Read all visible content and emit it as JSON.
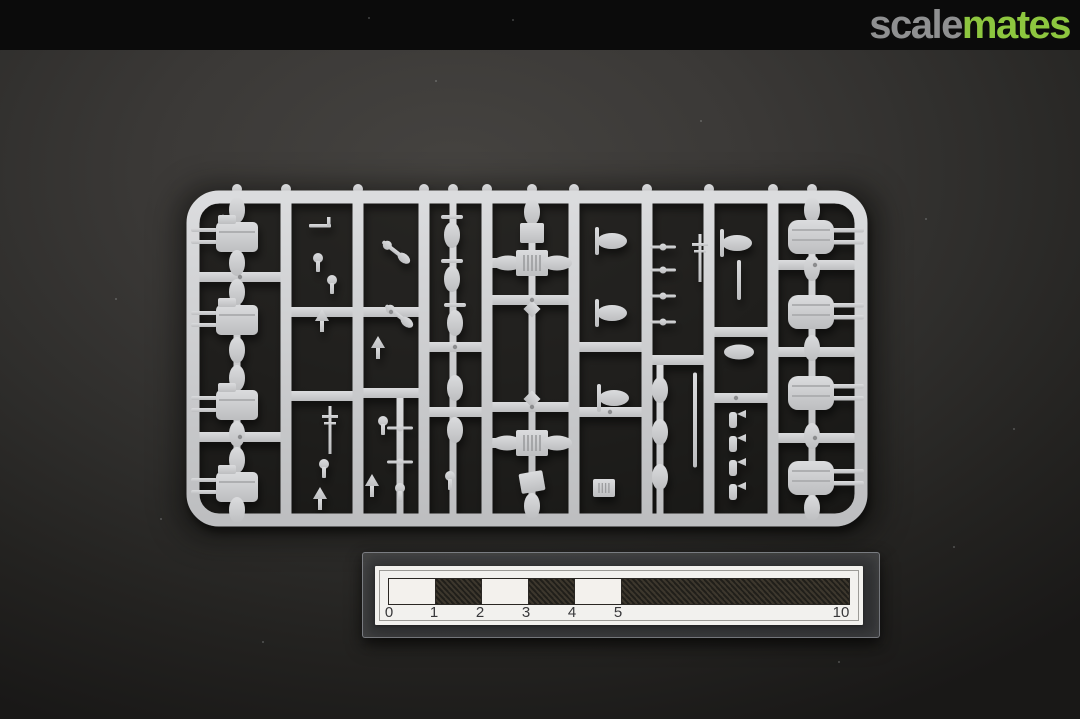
{
  "header": {
    "logo_scale": "scale",
    "logo_mates": "mates",
    "scale_color": "#8f9091",
    "mates_color": "#8dc63f",
    "bar_color": "#0b0b0b"
  },
  "scene": {
    "background_center": "#454340",
    "background_edge": "#191817",
    "subject": "injection-molded model kit sprue, light grey plastic, ship fittings parts",
    "specks": [
      [
        368,
        17
      ],
      [
        512,
        19
      ],
      [
        222,
        214
      ],
      [
        925,
        218
      ],
      [
        700,
        120
      ],
      [
        1013,
        428
      ],
      [
        115,
        298
      ],
      [
        953,
        546
      ],
      [
        262,
        641
      ],
      [
        838,
        661
      ],
      [
        160,
        518
      ],
      [
        435,
        80
      ]
    ]
  },
  "sprue": {
    "plastic_light": "#dbdcde",
    "plastic_dark": "#bdbec0",
    "ejector_dot_color": "#8b8c8e",
    "frame": {
      "x": 193,
      "y": 197,
      "w": 668,
      "h": 323,
      "rx": 26,
      "rail": 13
    },
    "runners": [
      286,
      358,
      424,
      487,
      574,
      647,
      709,
      773
    ],
    "chains": [
      [
        237,
        197,
        520
      ],
      [
        453,
        197,
        520
      ],
      [
        532,
        197,
        520
      ],
      [
        812,
        197,
        520
      ],
      [
        660,
        360,
        520
      ],
      [
        400,
        393,
        518
      ]
    ],
    "crossbars": [
      [
        193,
        286,
        277
      ],
      [
        193,
        286,
        437
      ],
      [
        286,
        358,
        312
      ],
      [
        286,
        358,
        396
      ],
      [
        358,
        424,
        312
      ],
      [
        358,
        424,
        393
      ],
      [
        424,
        487,
        347
      ],
      [
        424,
        487,
        412
      ],
      [
        487,
        574,
        300
      ],
      [
        487,
        574,
        407
      ],
      [
        487,
        517,
        263
      ],
      [
        547,
        574,
        263
      ],
      [
        487,
        517,
        443
      ],
      [
        547,
        574,
        443
      ],
      [
        574,
        647,
        347
      ],
      [
        574,
        647,
        412
      ],
      [
        647,
        709,
        360
      ],
      [
        709,
        773,
        332
      ],
      [
        709,
        773,
        398
      ],
      [
        773,
        857,
        265
      ],
      [
        773,
        857,
        352
      ],
      [
        773,
        857,
        438
      ]
    ],
    "parts": [
      {
        "t": "ovalV",
        "x": 237,
        "y": 210
      },
      {
        "t": "turretL",
        "x": 237,
        "y": 237
      },
      {
        "t": "ovalV",
        "x": 237,
        "y": 263
      },
      {
        "t": "ovalV",
        "x": 237,
        "y": 292
      },
      {
        "t": "turretL",
        "x": 237,
        "y": 320
      },
      {
        "t": "ovalV",
        "x": 237,
        "y": 350
      },
      {
        "t": "ovalV",
        "x": 237,
        "y": 378
      },
      {
        "t": "turretL",
        "x": 237,
        "y": 405
      },
      {
        "t": "ovalV",
        "x": 237,
        "y": 434
      },
      {
        "t": "ovalV",
        "x": 237,
        "y": 460
      },
      {
        "t": "turretL",
        "x": 237,
        "y": 487
      },
      {
        "t": "ovalV",
        "x": 237,
        "y": 510
      },
      {
        "t": "davit",
        "x": 320,
        "y": 226
      },
      {
        "t": "mountS",
        "x": 318,
        "y": 262
      },
      {
        "t": "mountS",
        "x": 332,
        "y": 284
      },
      {
        "t": "arrow",
        "x": 322,
        "y": 320
      },
      {
        "t": "mastV",
        "x": 330,
        "y": 430
      },
      {
        "t": "mountS",
        "x": 324,
        "y": 468
      },
      {
        "t": "arrow",
        "x": 320,
        "y": 498
      },
      {
        "t": "diag",
        "x": 396,
        "y": 252,
        "rot": 38
      },
      {
        "t": "diag",
        "x": 399,
        "y": 316,
        "rot": 38
      },
      {
        "t": "arrow",
        "x": 378,
        "y": 347
      },
      {
        "t": "mountS",
        "x": 383,
        "y": 425
      },
      {
        "t": "yardH",
        "x": 400,
        "y": 428
      },
      {
        "t": "yardH",
        "x": 400,
        "y": 462
      },
      {
        "t": "arrow",
        "x": 372,
        "y": 485
      },
      {
        "t": "mountS",
        "x": 400,
        "y": 492
      },
      {
        "t": "gunmount",
        "x": 452,
        "y": 232
      },
      {
        "t": "gunmount",
        "x": 452,
        "y": 276
      },
      {
        "t": "gunmount",
        "x": 455,
        "y": 320
      },
      {
        "t": "ovalV",
        "x": 455,
        "y": 388
      },
      {
        "t": "ovalV",
        "x": 455,
        "y": 430
      },
      {
        "t": "mountS",
        "x": 450,
        "y": 480
      },
      {
        "t": "ovalV",
        "x": 532,
        "y": 212
      },
      {
        "t": "box",
        "x": 532,
        "y": 233
      },
      {
        "t": "boatH",
        "x": 508,
        "y": 263
      },
      {
        "t": "grate",
        "x": 532,
        "y": 263
      },
      {
        "t": "boatH",
        "x": 557,
        "y": 263
      },
      {
        "t": "diamond",
        "x": 532,
        "y": 309
      },
      {
        "t": "diamond",
        "x": 532,
        "y": 399
      },
      {
        "t": "boatH",
        "x": 507,
        "y": 443
      },
      {
        "t": "grate",
        "x": 532,
        "y": 443
      },
      {
        "t": "boatH",
        "x": 557,
        "y": 443
      },
      {
        "t": "box",
        "x": 532,
        "y": 482,
        "rot": -10
      },
      {
        "t": "ovalV",
        "x": 532,
        "y": 506
      },
      {
        "t": "tmount",
        "x": 610,
        "y": 241
      },
      {
        "t": "tmount",
        "x": 610,
        "y": 313
      },
      {
        "t": "tmount",
        "x": 612,
        "y": 398
      },
      {
        "t": "grateS",
        "x": 604,
        "y": 488
      },
      {
        "t": "yardH",
        "x": 663,
        "y": 247
      },
      {
        "t": "yardH",
        "x": 663,
        "y": 270
      },
      {
        "t": "yardH",
        "x": 663,
        "y": 296
      },
      {
        "t": "yardH",
        "x": 663,
        "y": 322
      },
      {
        "t": "mastV",
        "x": 700,
        "y": 258
      },
      {
        "t": "ovalV",
        "x": 660,
        "y": 390
      },
      {
        "t": "ovalV",
        "x": 660,
        "y": 432
      },
      {
        "t": "ovalV",
        "x": 660,
        "y": 477
      },
      {
        "t": "pole",
        "x": 695,
        "y": 420,
        "len": 95
      },
      {
        "t": "tmount",
        "x": 735,
        "y": 243
      },
      {
        "t": "pole",
        "x": 739,
        "y": 280,
        "len": 40
      },
      {
        "t": "boatH",
        "x": 739,
        "y": 352
      },
      {
        "t": "charge",
        "x": 733,
        "y": 420
      },
      {
        "t": "charge",
        "x": 733,
        "y": 444
      },
      {
        "t": "charge",
        "x": 733,
        "y": 468
      },
      {
        "t": "charge",
        "x": 733,
        "y": 492
      },
      {
        "t": "ovalV",
        "x": 812,
        "y": 210
      },
      {
        "t": "turretR",
        "x": 812,
        "y": 237
      },
      {
        "t": "ovalV",
        "x": 812,
        "y": 268
      },
      {
        "t": "turretR",
        "x": 812,
        "y": 312
      },
      {
        "t": "ovalV",
        "x": 812,
        "y": 348
      },
      {
        "t": "turretR",
        "x": 812,
        "y": 393
      },
      {
        "t": "ovalV",
        "x": 812,
        "y": 436
      },
      {
        "t": "turretR",
        "x": 812,
        "y": 478
      },
      {
        "t": "ovalV",
        "x": 812,
        "y": 508
      }
    ],
    "dots": [
      [
        240,
        277
      ],
      [
        240,
        437
      ],
      [
        391,
        312
      ],
      [
        455,
        347
      ],
      [
        532,
        300
      ],
      [
        532,
        407
      ],
      [
        610,
        412
      ],
      [
        736,
        398
      ],
      [
        815,
        265
      ],
      [
        815,
        438
      ]
    ]
  },
  "ruler": {
    "unit_px": 46,
    "bar": {
      "segments": [
        {
          "units": 1,
          "dark": false
        },
        {
          "units": 1,
          "dark": true
        },
        {
          "units": 1,
          "dark": false
        },
        {
          "units": 1,
          "dark": true
        },
        {
          "units": 1,
          "dark": false
        },
        {
          "units": 5,
          "dark": true
        }
      ]
    },
    "ticks": [
      {
        "label": "0",
        "x": 389
      },
      {
        "label": "1",
        "x": 434
      },
      {
        "label": "2",
        "x": 480
      },
      {
        "label": "3",
        "x": 526
      },
      {
        "label": "4",
        "x": 572
      },
      {
        "label": "5",
        "x": 618
      },
      {
        "label": "10",
        "x": 841
      }
    ]
  }
}
